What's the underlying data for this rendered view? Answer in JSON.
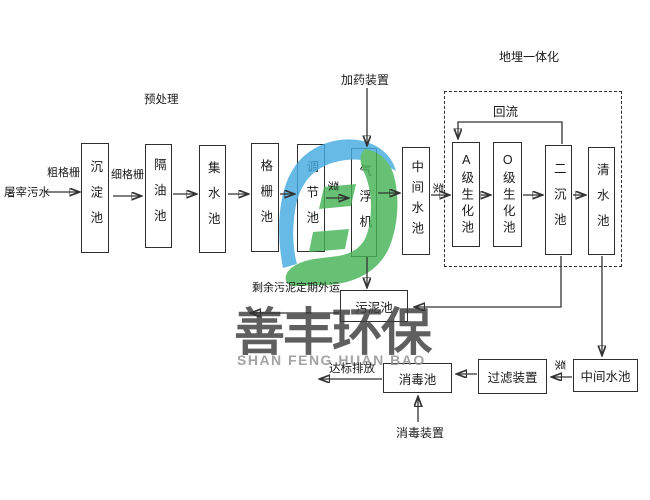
{
  "watermark": {
    "brand_cn": "善丰环保",
    "brand_en": "SHAN FENG HUAN BAO"
  },
  "labels": {
    "influent": "屠宰污水",
    "coarse_screen": "粗格栅",
    "fine_screen": "细格栅",
    "pretreatment": "预处理",
    "dosing_device": "加药装置",
    "buried_integration": "地埋一体化",
    "reflux": "回流",
    "pump": "泵",
    "excess_sludge": "剩余污泥定期外运",
    "discharge": "达标排放",
    "disinfection_device": "消毒装置"
  },
  "tanks": {
    "sedimentation": "沉淀池",
    "oil_separation": "隔油池",
    "water_collection": "集水池",
    "screen_tank": "格栅池",
    "regulating": "调节池",
    "air_flotation": "气浮机",
    "intermediate": "中间水池",
    "a_biochemical": "A级生化池",
    "o_biochemical": "O级生化池",
    "secondary_sedimentation": "二沉池",
    "clear_water": "清水池",
    "sludge": "污泥池",
    "disinfection": "消毒池",
    "filter_device": "过滤装置",
    "intermediate_2": "中间水池"
  },
  "colors": {
    "logo_blue": "#45ACE0",
    "logo_green": "#46B456",
    "box_shadow": "#c9c9c9",
    "line": "#333333"
  }
}
